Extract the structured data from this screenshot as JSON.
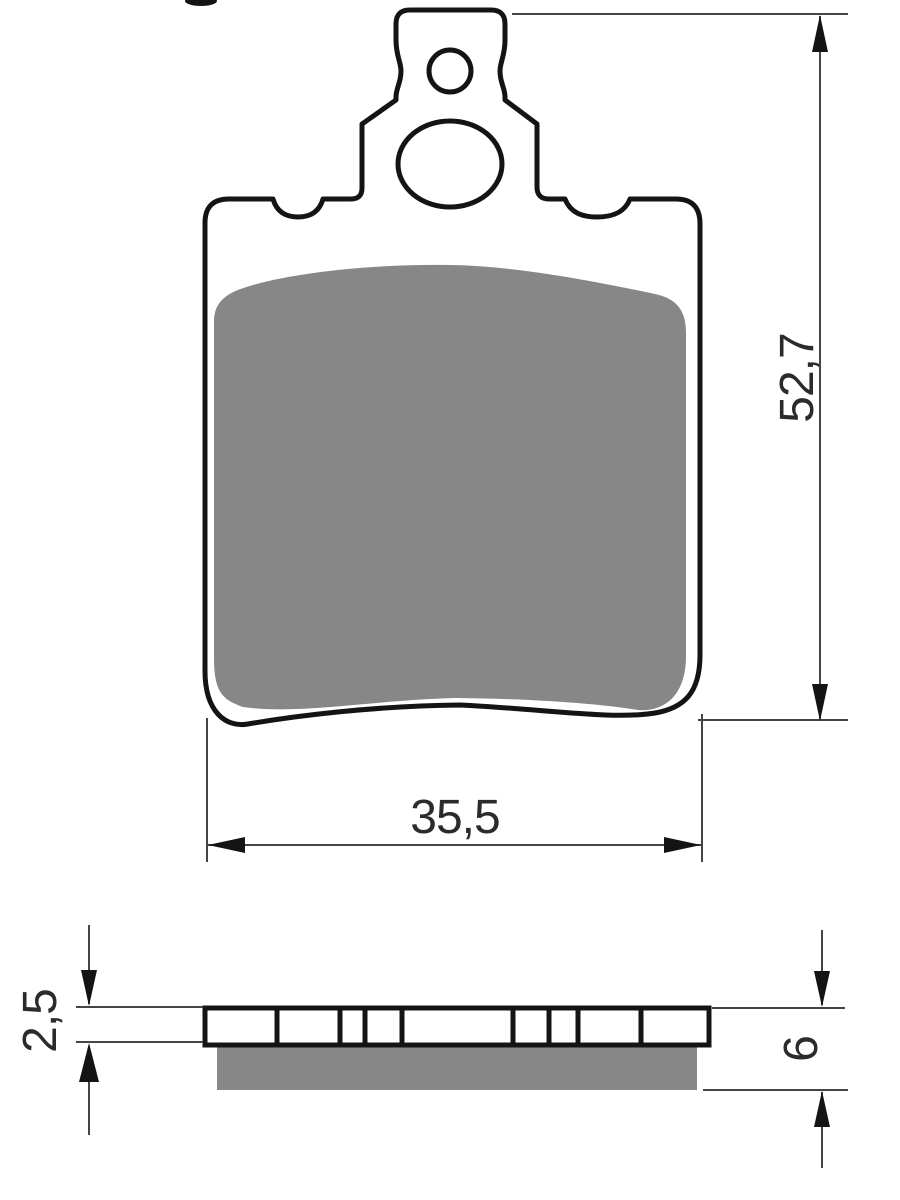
{
  "dimensions": {
    "height": "52,7",
    "width": "35,5",
    "backplate_thickness": "2,5",
    "total_thickness": "6"
  },
  "colors": {
    "outline": "#141414",
    "friction_material": "#878787",
    "dimension_line": "#454545",
    "text": "#2b2b2b",
    "background": "#ffffff"
  }
}
